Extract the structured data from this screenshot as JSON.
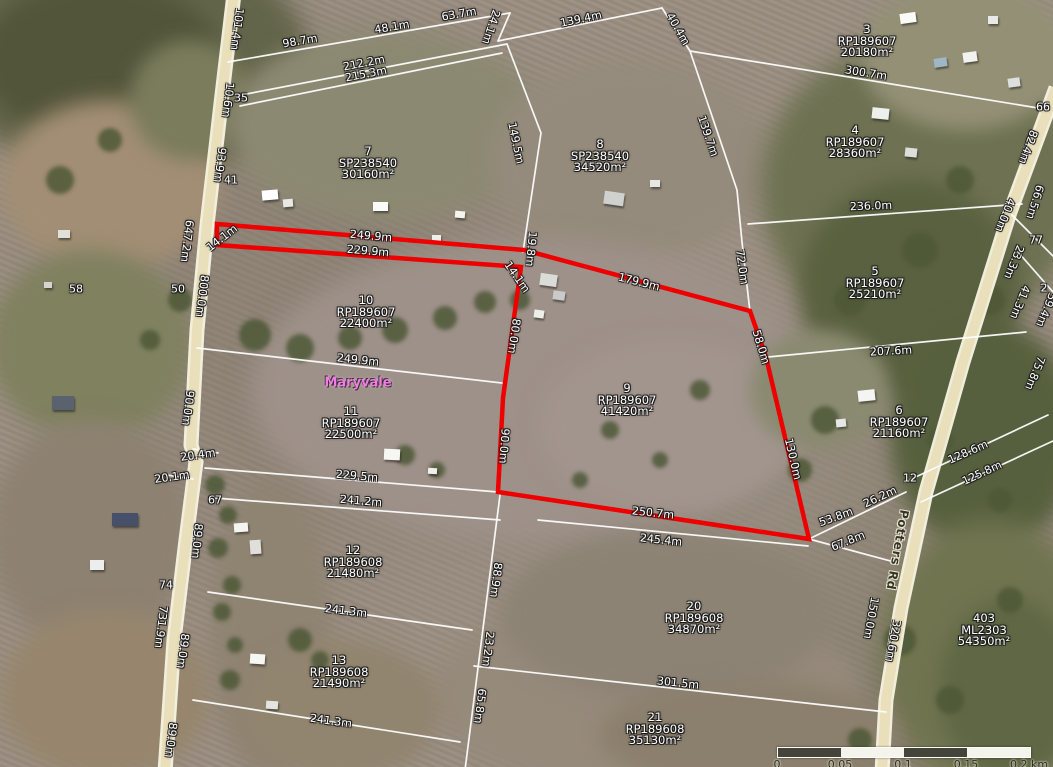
{
  "map": {
    "highlight_color": "#ee0000",
    "boundary_color": "#ffffff",
    "place_label": {
      "text": "Maryvale",
      "color": "#ee7fe0",
      "x": 358,
      "y": 383
    },
    "road_label": {
      "text": "Potters Rd",
      "x": 897,
      "y": 550,
      "angle": 100
    },
    "parcels": [
      {
        "lot": "3",
        "plan": "RP189607",
        "area": "20180m²",
        "x": 867,
        "y": 41,
        "highlighted": false
      },
      {
        "lot": "4",
        "plan": "RP189607",
        "area": "28360m²",
        "x": 855,
        "y": 142,
        "highlighted": false
      },
      {
        "lot": "7",
        "plan": "SP238540",
        "area": "30160m²",
        "x": 368,
        "y": 163,
        "highlighted": false
      },
      {
        "lot": "8",
        "plan": "SP238540",
        "area": "34520m²",
        "x": 600,
        "y": 156,
        "highlighted": false
      },
      {
        "lot": "5",
        "plan": "RP189607",
        "area": "25210m²",
        "x": 875,
        "y": 283,
        "highlighted": false
      },
      {
        "lot": "10",
        "plan": "RP189607",
        "area": "22400m²",
        "x": 366,
        "y": 312,
        "highlighted": false
      },
      {
        "lot": "9",
        "plan": "RP189607",
        "area": "41420m²",
        "x": 627,
        "y": 400,
        "highlighted": true
      },
      {
        "lot": "11",
        "plan": "RP189607",
        "area": "22500m²",
        "x": 351,
        "y": 423,
        "highlighted": false
      },
      {
        "lot": "6",
        "plan": "RP189607",
        "area": "21160m²",
        "x": 899,
        "y": 422,
        "highlighted": false
      },
      {
        "lot": "12",
        "plan": "RP189608",
        "area": "21480m²",
        "x": 353,
        "y": 562,
        "highlighted": false
      },
      {
        "lot": "13",
        "plan": "RP189608",
        "area": "21490m²",
        "x": 339,
        "y": 672,
        "highlighted": false
      },
      {
        "lot": "20",
        "plan": "RP189608",
        "area": "34870m²",
        "x": 694,
        "y": 618,
        "highlighted": false
      },
      {
        "lot": "21",
        "plan": "RP189608",
        "area": "35130m²",
        "x": 655,
        "y": 729,
        "highlighted": false
      },
      {
        "lot": "403",
        "plan": "ML2303",
        "area": "54350m²",
        "x": 984,
        "y": 630,
        "highlighted": false
      }
    ],
    "measurements": [
      {
        "text": "101.4m",
        "x": 237,
        "y": 29,
        "a": 97
      },
      {
        "text": "98.7m",
        "x": 300,
        "y": 41,
        "a": -10
      },
      {
        "text": "48.1m",
        "x": 392,
        "y": 27,
        "a": -10
      },
      {
        "text": "63.7m",
        "x": 459,
        "y": 14,
        "a": -10
      },
      {
        "text": "24.1m",
        "x": 491,
        "y": 27,
        "a": 108
      },
      {
        "text": "139.4m",
        "x": 581,
        "y": 19,
        "a": -12
      },
      {
        "text": "40.4m",
        "x": 678,
        "y": 29,
        "a": 60
      },
      {
        "text": "212.2m",
        "x": 364,
        "y": 63,
        "a": -11
      },
      {
        "text": "215.3m",
        "x": 366,
        "y": 74,
        "a": -11
      },
      {
        "text": "10.6m",
        "x": 228,
        "y": 100,
        "a": 97
      },
      {
        "text": "93.9m",
        "x": 220,
        "y": 165,
        "a": 97
      },
      {
        "text": "149.5m",
        "x": 516,
        "y": 143,
        "a": 78
      },
      {
        "text": "139.7m",
        "x": 708,
        "y": 136,
        "a": 71
      },
      {
        "text": "300.7m",
        "x": 866,
        "y": 73,
        "a": 9
      },
      {
        "text": "82.4m",
        "x": 1028,
        "y": 147,
        "a": 110
      },
      {
        "text": "647.2m",
        "x": 187,
        "y": 241,
        "a": 97
      },
      {
        "text": "14.1m",
        "x": 222,
        "y": 238,
        "a": -38
      },
      {
        "text": "249.9m",
        "x": 371,
        "y": 236,
        "a": 5
      },
      {
        "text": "229.9m",
        "x": 368,
        "y": 251,
        "a": 5
      },
      {
        "text": "19.8m",
        "x": 531,
        "y": 249,
        "a": 95
      },
      {
        "text": "14.1m",
        "x": 517,
        "y": 277,
        "a": 55
      },
      {
        "text": "179.9m",
        "x": 639,
        "y": 282,
        "a": 14
      },
      {
        "text": "72.0m",
        "x": 742,
        "y": 267,
        "a": 82
      },
      {
        "text": "236.0m",
        "x": 871,
        "y": 206,
        "a": -2
      },
      {
        "text": "66.5m",
        "x": 1035,
        "y": 202,
        "a": 107
      },
      {
        "text": "40.0m",
        "x": 1005,
        "y": 215,
        "a": 112
      },
      {
        "text": "23.3m",
        "x": 1014,
        "y": 262,
        "a": 112
      },
      {
        "text": "41.3m",
        "x": 1020,
        "y": 302,
        "a": 112
      },
      {
        "text": "59.4m",
        "x": 1046,
        "y": 310,
        "a": 112
      },
      {
        "text": "800.0m",
        "x": 202,
        "y": 296,
        "a": 97
      },
      {
        "text": "58.0m",
        "x": 761,
        "y": 347,
        "a": 73
      },
      {
        "text": "80.0m",
        "x": 514,
        "y": 336,
        "a": 98
      },
      {
        "text": "207.6m",
        "x": 891,
        "y": 351,
        "a": -3
      },
      {
        "text": "75.8m",
        "x": 1035,
        "y": 373,
        "a": 112
      },
      {
        "text": "249.9m",
        "x": 358,
        "y": 360,
        "a": 6
      },
      {
        "text": "90.0m",
        "x": 188,
        "y": 408,
        "a": 97
      },
      {
        "text": "90.0m",
        "x": 504,
        "y": 446,
        "a": 94
      },
      {
        "text": "130.0m",
        "x": 793,
        "y": 459,
        "a": 77
      },
      {
        "text": "128.6m",
        "x": 968,
        "y": 452,
        "a": -24
      },
      {
        "text": "125.8m",
        "x": 982,
        "y": 473,
        "a": -25
      },
      {
        "text": "20.4m",
        "x": 198,
        "y": 455,
        "a": -8
      },
      {
        "text": "20.1m",
        "x": 172,
        "y": 477,
        "a": -8
      },
      {
        "text": "229.5m",
        "x": 357,
        "y": 476,
        "a": 5
      },
      {
        "text": "241.2m",
        "x": 361,
        "y": 501,
        "a": 5
      },
      {
        "text": "250.7m",
        "x": 653,
        "y": 513,
        "a": 6
      },
      {
        "text": "245.4m",
        "x": 661,
        "y": 540,
        "a": 6
      },
      {
        "text": "53.8m",
        "x": 836,
        "y": 517,
        "a": -20
      },
      {
        "text": "26.2m",
        "x": 880,
        "y": 497,
        "a": -25
      },
      {
        "text": "67.8m",
        "x": 848,
        "y": 541,
        "a": -22
      },
      {
        "text": "88.9m",
        "x": 496,
        "y": 580,
        "a": 97
      },
      {
        "text": "23.2m",
        "x": 488,
        "y": 649,
        "a": 97
      },
      {
        "text": "65.8m",
        "x": 480,
        "y": 706,
        "a": 97
      },
      {
        "text": "89.0m",
        "x": 197,
        "y": 541,
        "a": 95
      },
      {
        "text": "731.9m",
        "x": 161,
        "y": 627,
        "a": 97
      },
      {
        "text": "89.0m",
        "x": 183,
        "y": 651,
        "a": 97
      },
      {
        "text": "89.0m",
        "x": 171,
        "y": 740,
        "a": 97
      },
      {
        "text": "241.3m",
        "x": 346,
        "y": 611,
        "a": 7
      },
      {
        "text": "241.3m",
        "x": 331,
        "y": 721,
        "a": 8
      },
      {
        "text": "301.5m",
        "x": 678,
        "y": 683,
        "a": 6
      },
      {
        "text": "150.0m",
        "x": 871,
        "y": 618,
        "a": 100
      },
      {
        "text": "320.6m",
        "x": 893,
        "y": 641,
        "a": 100
      }
    ],
    "house_numbers": [
      {
        "text": "35",
        "x": 241,
        "y": 98
      },
      {
        "text": "41",
        "x": 231,
        "y": 180
      },
      {
        "text": "50",
        "x": 178,
        "y": 289
      },
      {
        "text": "58",
        "x": 76,
        "y": 289
      },
      {
        "text": "66",
        "x": 1043,
        "y": 107
      },
      {
        "text": "77",
        "x": 1036,
        "y": 240
      },
      {
        "text": "2",
        "x": 1044,
        "y": 288
      },
      {
        "text": "12",
        "x": 910,
        "y": 478
      },
      {
        "text": "67",
        "x": 215,
        "y": 500
      },
      {
        "text": "74",
        "x": 166,
        "y": 585
      }
    ],
    "scalebar": {
      "ticks": [
        "0",
        "0.05",
        "0.1",
        "0.15",
        "0.2 km"
      ],
      "dark_color": "#44443a",
      "light_color": "#f4f3ec"
    }
  }
}
